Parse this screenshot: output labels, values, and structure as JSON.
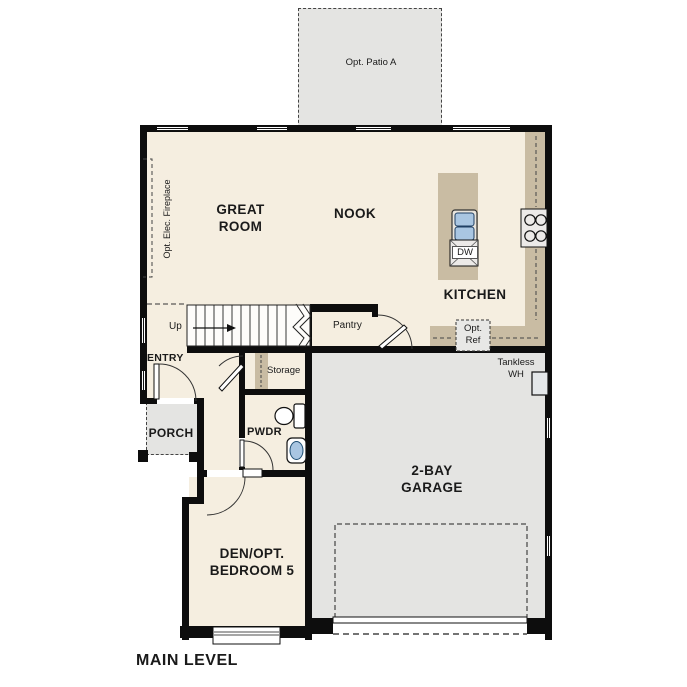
{
  "plan": {
    "title": "MAIN LEVEL",
    "labels": {
      "great_room": "GREAT\nROOM",
      "nook": "NOOK",
      "kitchen": "KITCHEN",
      "pantry": "Pantry",
      "storage": "Storage",
      "entry": "ENTRY",
      "porch": "PORCH",
      "pwdr": "PWDR",
      "den": "DEN/OPT.\nBEDROOM 5",
      "garage": "2-BAY\nGARAGE",
      "up": "Up",
      "opt_patio": "Opt. Patio A",
      "opt_elec_fireplace": "Opt. Elec. Fireplace",
      "opt_ref": "Opt.\nRef",
      "tankless_wh": "Tankless\nWH",
      "dishwasher": "DW"
    },
    "colors": {
      "floor": "#f5eee0",
      "optional_area_gray": "#e4e4e2",
      "counter_tan": "#c9bca3",
      "wall_black": "#0d0d0d",
      "fixture_blue": "#a9c6e2",
      "appliance_gray": "#eceae8"
    }
  }
}
